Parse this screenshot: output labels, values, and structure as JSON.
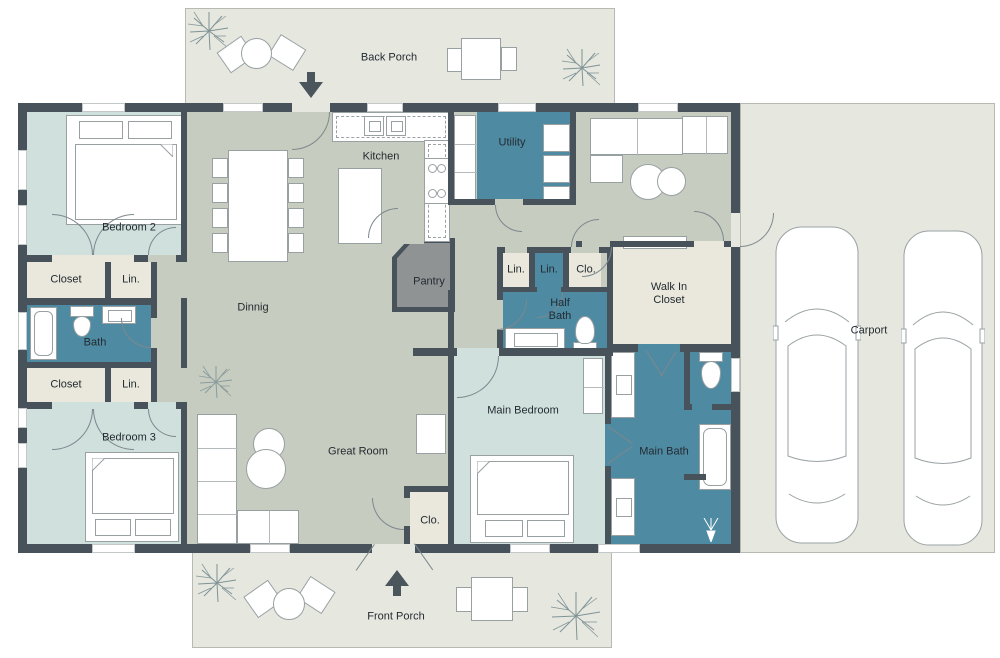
{
  "meta": {
    "type": "floor-plan",
    "description": "Single-story house floor plan with porches and carport"
  },
  "colors": {
    "wall": "#47525b",
    "floor_main": "#c6ccbf",
    "floor_bedroom": "#cfe0dd",
    "floor_bathroom": "#4e8aa2",
    "floor_closet": "#eae8dc",
    "floor_porch": "#e6e7df",
    "floor_pantry": "#8f9394",
    "furniture_outline": "#98a0a2",
    "label_text": "#232b31"
  },
  "rooms": {
    "back_porch": {
      "label": "Back Porch"
    },
    "front_porch": {
      "label": "Front Porch"
    },
    "carport": {
      "label": "Carport"
    },
    "kitchen": {
      "label": "Kitchen"
    },
    "utility": {
      "label": "Utility"
    },
    "bedroom2": {
      "label": "Bedroom 2"
    },
    "bedroom3": {
      "label": "Bedroom 3"
    },
    "closet_bedroom2": {
      "label": "Closet"
    },
    "closet_bedroom3": {
      "label": "Closet"
    },
    "linen_bedroom2": {
      "label": "Lin."
    },
    "linen_bedroom3": {
      "label": "Lin."
    },
    "bath": {
      "label": "Bath"
    },
    "dining": {
      "label": "Dinnig"
    },
    "pantry": {
      "label": "Pantry"
    },
    "linen_hall_1": {
      "label": "Lin."
    },
    "linen_hall_2": {
      "label": "Lin."
    },
    "closet_hall": {
      "label": "Clo."
    },
    "half_bath": {
      "label": "Half Bath"
    },
    "walk_in_closet": {
      "label": "Walk In Closet"
    },
    "great_room": {
      "label": "Great Room"
    },
    "main_bedroom": {
      "label": "Main Bedroom"
    },
    "main_bath": {
      "label": "Main Bath"
    },
    "closet_entry": {
      "label": "Clo."
    }
  }
}
